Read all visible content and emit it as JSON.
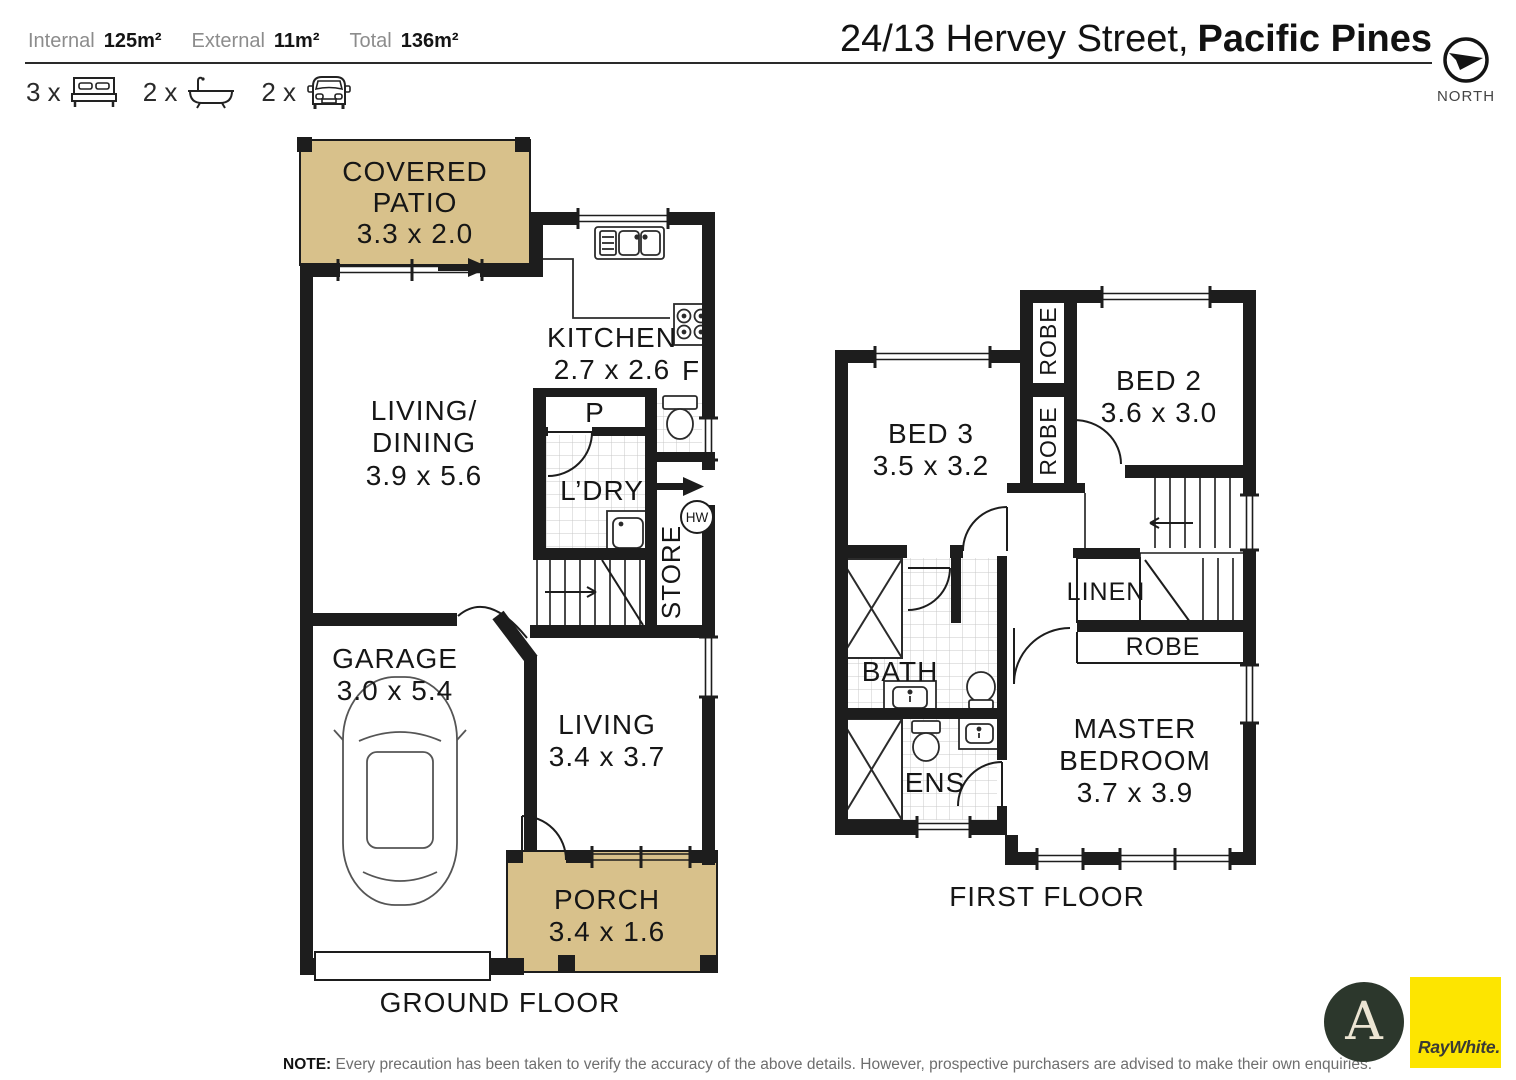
{
  "header": {
    "stats": [
      {
        "label": "Internal",
        "value": "125m²"
      },
      {
        "label": "External",
        "value": "11m²"
      },
      {
        "label": "Total",
        "value": "136m²"
      }
    ],
    "features": {
      "beds": "3 x",
      "baths": "2 x",
      "cars": "2 x"
    },
    "icons": [
      "bed-icon",
      "bath-icon",
      "car-icon",
      "compass-north-icon"
    ],
    "title": {
      "regular": "24/13 Hervey Street,",
      "bold": "Pacific Pines"
    },
    "compass_label": "NORTH"
  },
  "ground_floor": {
    "label": "GROUND FLOOR",
    "covered_patio": {
      "line1": "COVERED",
      "line2": "PATIO",
      "dims": "3.3 x 2.0"
    },
    "living_dining": {
      "line1": "LIVING/",
      "line2": "DINING",
      "dims": "3.9 x 5.6"
    },
    "kitchen": {
      "name": "KITCHEN",
      "dims": "2.7 x 2.6"
    },
    "fridge": "F",
    "pantry": "P",
    "laundry": "L’DRY",
    "store": "STORE",
    "hot_water": "HW",
    "garage": {
      "name": "GARAGE",
      "dims": "3.0 x 5.4"
    },
    "living": {
      "name": "LIVING",
      "dims": "3.4 x 3.7"
    },
    "porch": {
      "name": "PORCH",
      "dims": "3.4 x 1.6"
    }
  },
  "first_floor": {
    "label": "FIRST FLOOR",
    "bed2": {
      "name": "BED 2",
      "dims": "3.6 x 3.0"
    },
    "bed3": {
      "name": "BED 3",
      "dims": "3.5 x 3.2"
    },
    "robe_bed2": "ROBE",
    "robe_bed3": "ROBE",
    "linen": "LINEN",
    "robe_master": "ROBE",
    "bath": "BATH",
    "ens": "ENS",
    "master": {
      "line1": "MASTER",
      "line2": "BEDROOM",
      "dims": "3.7 x 3.9"
    }
  },
  "footer": {
    "note_label": "NOTE:",
    "note_text": "Every precaution has been taken to verify the accuracy of the above details. However, prospective purchasers are advised to make their own enquiries."
  },
  "branding": {
    "agent_monogram": "A",
    "brand_name": "RayWhite."
  },
  "colors": {
    "outdoor_fill": "#d8c18b",
    "wall": "#1d1d1d",
    "brand_yellow": "#fde500",
    "agent_green": "#2c372c"
  }
}
